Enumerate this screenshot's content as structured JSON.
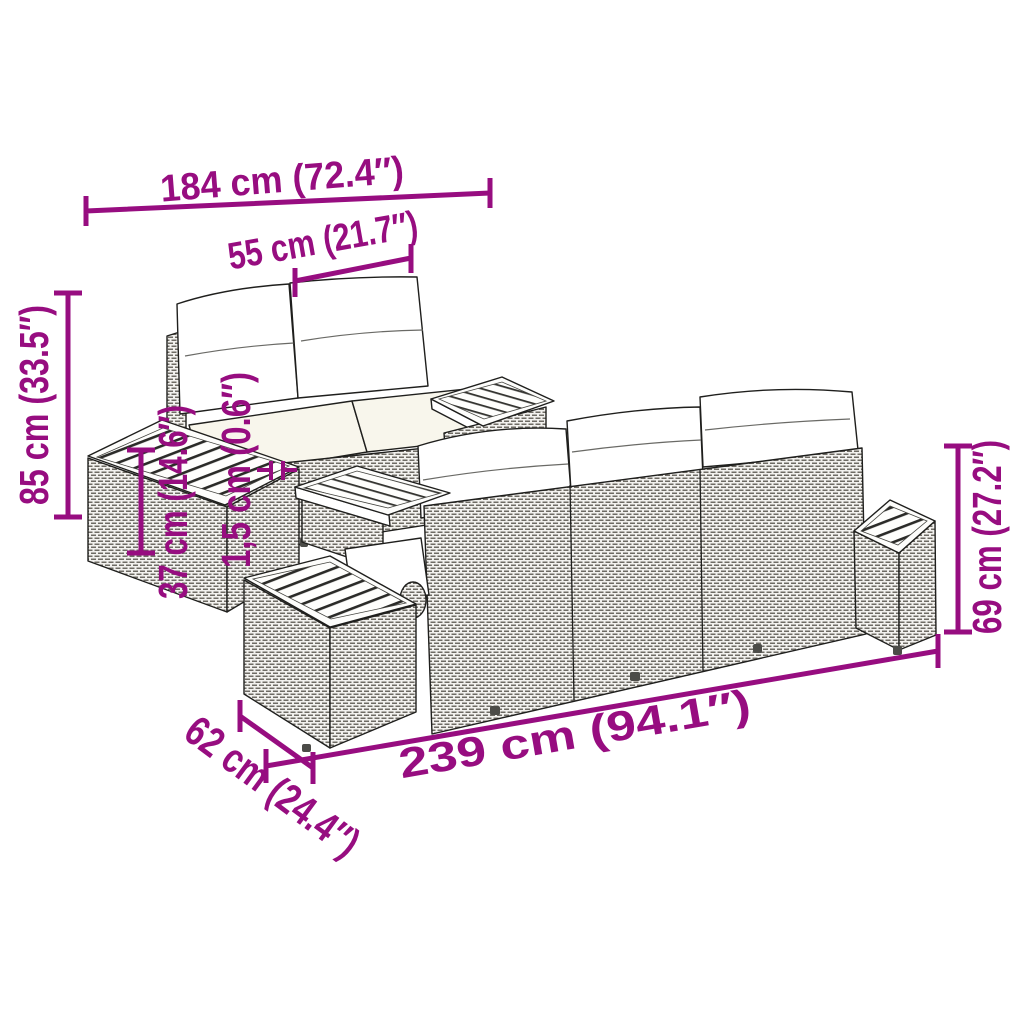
{
  "image": {
    "kind": "product-dimension-diagram",
    "subject": "rattan-garden-lounge-set",
    "background": "#ffffff"
  },
  "colors": {
    "accent": "#970d80",
    "outline": "#1f1f1d",
    "cushion": "#ffffff"
  },
  "dimensions": {
    "total_width": {
      "label": "184 cm (72.4″)"
    },
    "seat_width": {
      "label": "55 cm (21.7″)"
    },
    "total_height": {
      "label": "85 cm (33.5″)"
    },
    "side_table_height": {
      "label": "37 cm (14.6″)"
    },
    "tabletop_thickness": {
      "label": "1,5 cm (0.6″)"
    },
    "back_height": {
      "label": "69 cm (27.2″)"
    },
    "sofa_length": {
      "label": "239 cm (94.1″)"
    },
    "sofa_depth": {
      "label": "62 cm (24.4″)"
    }
  },
  "scene": {
    "items": [
      "two-seater-sofa-with-cushions",
      "left-side-table-with-slatted-top",
      "middle-coffee-table-with-slatted-top",
      "three-seater-sofa-back-view-with-cushions",
      "right-end-table-with-slatted-top",
      "front-end-table-with-slatted-top"
    ]
  }
}
